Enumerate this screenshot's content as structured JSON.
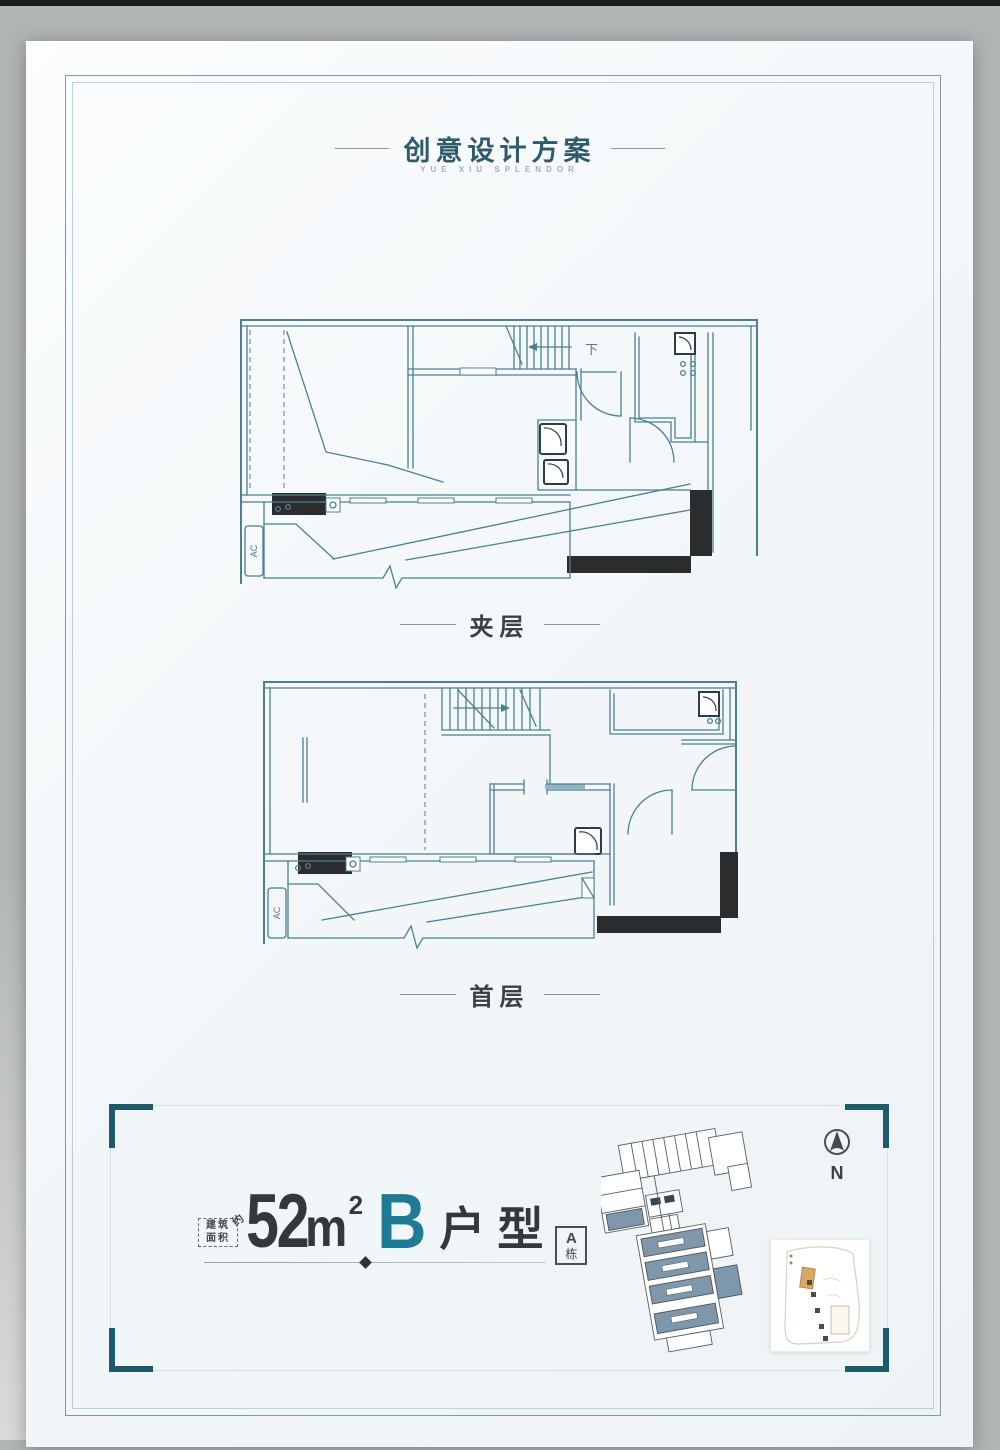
{
  "page": {
    "title": "创意设计方案",
    "subtitle": "YUE XIU SPLENDOR"
  },
  "plans": {
    "mezzanine": {
      "label": "夹层",
      "stair_label": "下",
      "ac_label": "AC"
    },
    "first_floor": {
      "label": "首层",
      "ac_label": "AC"
    }
  },
  "unit": {
    "area_note_line1": "建筑",
    "area_note_line2": "面积",
    "area_note_approx": "约",
    "area_value": "52",
    "area_unit": "m",
    "area_exponent": "2",
    "type_letter": "B",
    "type_suffix": "户型",
    "building_letter": "A",
    "building_suffix": "栋"
  },
  "compass": {
    "label": "N"
  },
  "colors": {
    "accent_teal": "#1e7b93",
    "plan_line": "#4a8090",
    "bracket_teal": "#1d5b6b",
    "dark_text": "#33383c",
    "page_bg": "#f3f7f9",
    "outer_bg": "#b1b4b5"
  }
}
